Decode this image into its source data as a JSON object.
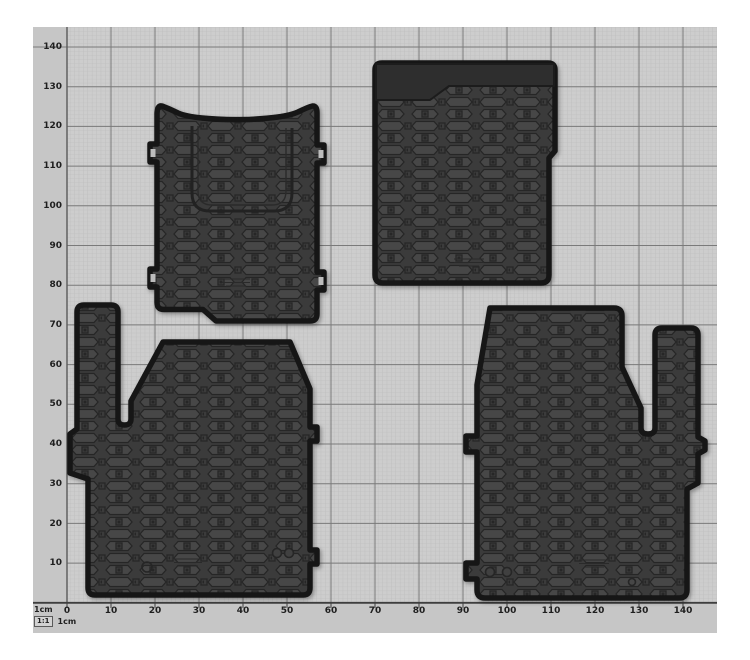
{
  "grid": {
    "y_labels": [
      "140",
      "130",
      "120",
      "110",
      "100",
      "90",
      "80",
      "70",
      "60",
      "50",
      "40",
      "30",
      "20",
      "10"
    ],
    "x_labels": [
      "0",
      "10",
      "20",
      "30",
      "40",
      "50",
      "60",
      "70",
      "80",
      "90",
      "100",
      "110",
      "120",
      "130",
      "140"
    ]
  },
  "legend": {
    "unit_top": "1cm",
    "scale_ratio": "1:1",
    "unit_bottom": "1cm"
  },
  "colors": {
    "photo_bg": "#c6c6c6",
    "grid_bg": "#cdcdcd",
    "grid_fine": "#b9b9b9",
    "grid_bold": "#7a7a7a",
    "grid_axis": "#3e3e3e",
    "label_text": "#1f1f1f",
    "mat_base": "#3b3b3b",
    "mat_cell": "#474747",
    "mat_line": "#262626",
    "mat_rim": "#141414",
    "mat_band": "#2d2d2d"
  }
}
